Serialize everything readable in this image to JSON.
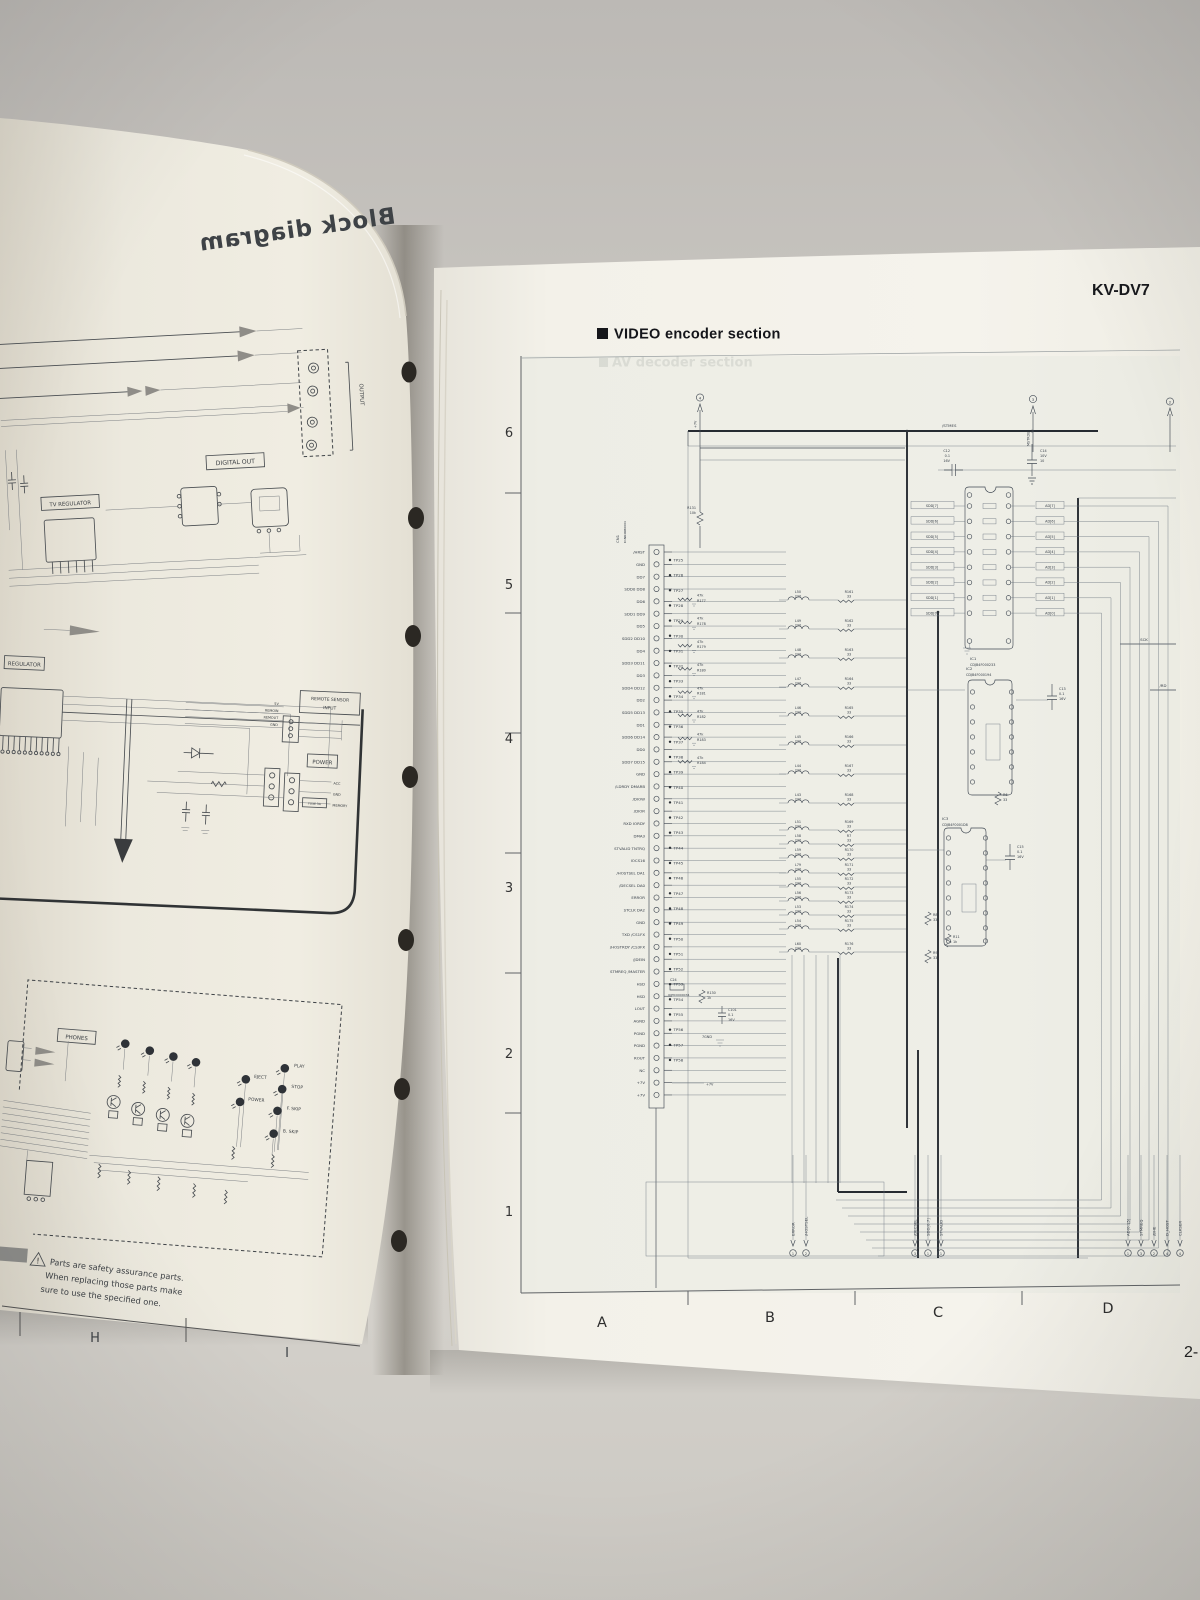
{
  "scene": {
    "model": "KV-DV7",
    "section_marker": "■",
    "section_title": "VIDEO encoder section",
    "ghost_section_title": "AV decoder section",
    "page_number": "2-"
  },
  "left_page": {
    "ghost_title": "Block diagram",
    "labels": {
      "output": "OUTPUT",
      "digital_out": "DIGITAL OUT",
      "tv_regulator": "TV REGULATOR",
      "regulator": "REGULATOR",
      "remote_sensor": [
        "REMOTE SENSOR",
        "INPUT"
      ],
      "power": "POWER",
      "phones": "PHONES",
      "fuse": "FUSE 3A"
    },
    "power_pins": [
      "ACC",
      "GND",
      "MEMORY"
    ],
    "rem_pins": [
      "5V",
      "REMOIN",
      "REMOUT",
      "GND"
    ],
    "leds_right": [
      "PLAY",
      "STOP",
      "F. SKIP",
      "B. SKIP"
    ],
    "leds_mid": [
      "EJECT",
      "POWER"
    ],
    "safety": [
      "Parts are safety assurance parts.",
      "When replacing those parts make",
      "sure to use the specified one."
    ],
    "grid_letters": [
      "H",
      "I"
    ]
  },
  "right_page": {
    "grid_rows": [
      "6",
      "5",
      "4",
      "3",
      "2",
      "1"
    ],
    "grid_cols": [
      "A",
      "B",
      "C",
      "D"
    ],
    "refs": {
      "top_left": "4",
      "top_mid": "3",
      "top_right": "2"
    },
    "sig": {
      "stmes": "/STMES",
      "mstrde": "MSTRDE",
      "p7v_top": "+7V",
      "p7v_bot": "+7V",
      "gnd7": "7GND",
      "sck": "SCK",
      "rd": "/RD"
    },
    "connector": {
      "name": "CN1",
      "part": "K1NR4RB0004",
      "pins": [
        "/HRST",
        "GND",
        "DD7",
        "SDD0 DD8",
        "DD6",
        "SDD1 DD9",
        "DD5",
        "SDD2 DD10",
        "DD4",
        "SDD3 DD11",
        "DD3",
        "SDD4 DD12",
        "DD2",
        "SDD5 DD13",
        "DD1",
        "SDD6 DD14",
        "DD0",
        "SDD7 DD15",
        "GND",
        "/LDRDY DMARB",
        "/DIOW",
        "/DIOR",
        "RXD IORDY",
        "DMA3",
        "STVALID TNTRQ",
        "IOCS16",
        "/HOSTSEL DA1",
        "/DECSEL DA0",
        "ERROR",
        "STCLK DA2",
        "GND",
        "TXD /CS1FX",
        "/HOSTRDY /CS3FX",
        "/JDEIN",
        "STMREQ /MASTER",
        "HSD",
        "HSD",
        "LOUT",
        "AGND",
        "PGND",
        "PGND",
        "ROUT",
        "NC",
        "+7V",
        "+7V"
      ]
    },
    "test_points": [
      "TP25",
      "TP26",
      "TP27",
      "TP28",
      "TP29",
      "TP30",
      "TP31",
      "TP32",
      "TP33",
      "TP34",
      "TP35",
      "TP36",
      "TP37",
      "TP38",
      "TP39",
      "TP40",
      "TP41",
      "TP42",
      "TP43",
      "TP44",
      "TP45",
      "TP46",
      "TP47",
      "TP48",
      "TP49",
      "TP50",
      "TP51",
      "TP52",
      "TP53",
      "TP54",
      "TP55",
      "TP56",
      "TP57",
      "TP58"
    ],
    "rc47": [
      "R177",
      "R178",
      "R179",
      "R180",
      "R181",
      "R182",
      "R183",
      "R184"
    ],
    "rc47_value": "47k",
    "r131": [
      "R131",
      "10k"
    ],
    "r130": [
      "R130",
      "1k"
    ],
    "c24": [
      "C24",
      "J0JHC0000034"
    ],
    "c101": [
      "C101",
      "0.1",
      "16V"
    ],
    "lc_rows": [
      {
        "l": "L50",
        "lv": "220",
        "r": "R161",
        "rv": "33"
      },
      {
        "l": "L49",
        "lv": "220",
        "r": "R162",
        "rv": "33"
      },
      {
        "l": "L48",
        "lv": "220",
        "r": "R163",
        "rv": "33"
      },
      {
        "l": "L47",
        "lv": "220",
        "r": "R164",
        "rv": "33"
      },
      {
        "l": "L46",
        "lv": "220",
        "r": "R165",
        "rv": "33"
      },
      {
        "l": "L45",
        "lv": "220",
        "r": "R166",
        "rv": "33"
      },
      {
        "l": "L44",
        "lv": "220",
        "r": "R167",
        "rv": "33"
      },
      {
        "l": "L43",
        "lv": "220",
        "r": "R168",
        "rv": "33"
      },
      {
        "l": "L51",
        "lv": "220",
        "r": "R169",
        "rv": "33"
      },
      {
        "l": "L58",
        "lv": "220",
        "r": "R7",
        "rv": "33"
      },
      {
        "l": "L59",
        "lv": "220",
        "r": "R170",
        "rv": "33"
      },
      {
        "l": "L79",
        "lv": "220",
        "r": "R171",
        "rv": "33"
      },
      {
        "l": "L55",
        "lv": "220",
        "r": "R172",
        "rv": "33"
      },
      {
        "l": "L56",
        "lv": "220",
        "r": "R173",
        "rv": "33"
      },
      {
        "l": "L53",
        "lv": "220",
        "r": "R174",
        "rv": "33"
      },
      {
        "l": "L54",
        "lv": "220",
        "r": "R175",
        "rv": "33"
      },
      {
        "l": "L60",
        "lv": "220",
        "r": "R176",
        "rv": "33"
      }
    ],
    "sdd_bus": [
      "SDD[7]",
      "SDD[6]",
      "SDD[5]",
      "SDD[4]",
      "SDD[3]",
      "SDD[2]",
      "SDD[1]",
      "SDD[0]"
    ],
    "ad_bus": [
      "AD[7]",
      "AD[6]",
      "AD[5]",
      "AD[4]",
      "AD[3]",
      "AD[2]",
      "AD[1]",
      "AD[0]"
    ],
    "ic1": {
      "name": "IC1",
      "part": "CDJB4F000233"
    },
    "ic2": {
      "name": "IC2",
      "part": "CDJB4F000194"
    },
    "ic3": {
      "name": "IC3",
      "part": "CDJB4F0001D8"
    },
    "caps": {
      "c12": [
        "C12",
        "0.1",
        "16V"
      ],
      "c13": [
        "C13",
        "0.1",
        "16V"
      ],
      "c14": [
        "C14",
        "10V",
        "10"
      ],
      "c15": [
        "C15",
        "0.1",
        "16V"
      ]
    },
    "resistors": {
      "r6": [
        "R6",
        "33"
      ],
      "r8": [
        "R8",
        "33"
      ],
      "r9": [
        "R9",
        "33"
      ],
      "r11": [
        "R11",
        "1k"
      ]
    },
    "bottom_groups": [
      [
        {
          "t": "ERROR",
          "r": "1"
        },
        {
          "t": "/HOSTSEL",
          "r": "2"
        }
      ],
      [
        {
          "t": "/DECSEL",
          "r": "3"
        },
        {
          "t": "SDD[0:7]",
          "r": "1"
        },
        {
          "t": "STVALID",
          "r": "1"
        }
      ],
      [
        {
          "t": "AD[0:15]",
          "r": "1"
        },
        {
          "t": "STMREQ",
          "r": "3"
        },
        {
          "t": "/BHE",
          "r": "2"
        },
        {
          "t": "D_HOST",
          "r": "4"
        },
        {
          "t": "CLKSER",
          "r": "4"
        }
      ]
    ]
  }
}
